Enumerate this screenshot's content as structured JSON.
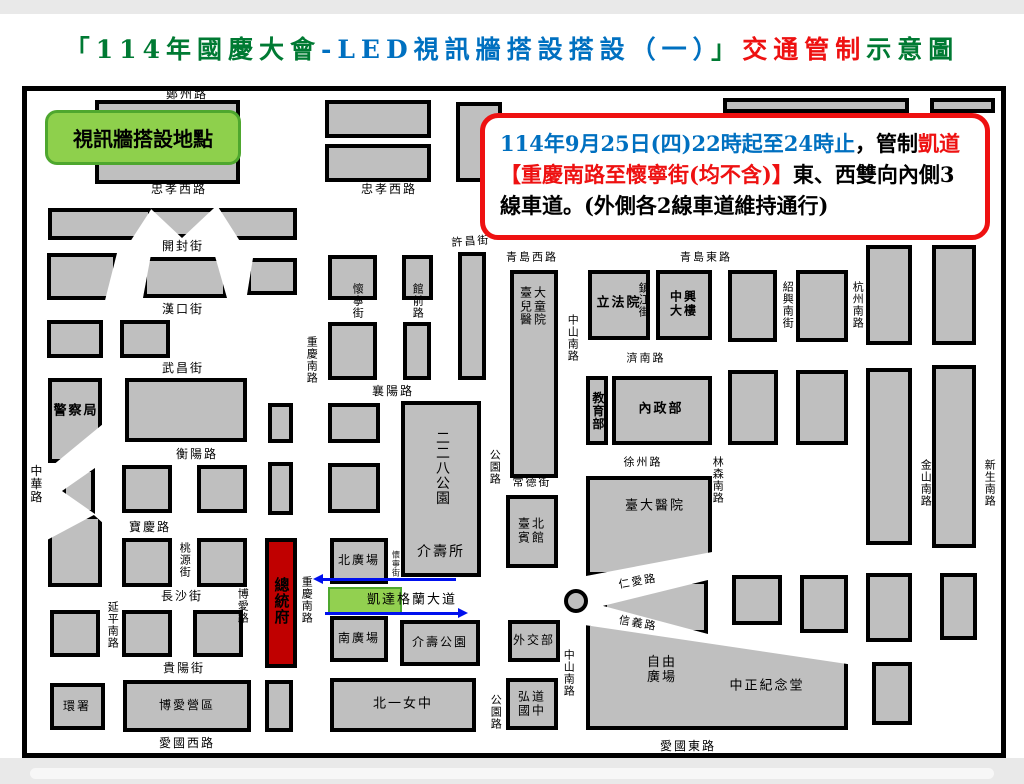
{
  "title": {
    "segments": [
      {
        "t": "「114年國慶大會",
        "c": "#007a33"
      },
      {
        "t": "-LED視訊牆搭設搭設（一）",
        "c": "#0070c0"
      },
      {
        "t": "」",
        "c": "#007a33"
      },
      {
        "t": "交通管制",
        "c": "#ee1111"
      },
      {
        "t": "示意圖",
        "c": "#007a33"
      }
    ]
  },
  "legend_box": {
    "label": "視訊牆搭設地點",
    "fill": "#8ed04c",
    "border": "#4ea72e"
  },
  "notice_box": {
    "border": "#ee1111",
    "lines": [
      [
        {
          "t": "114年9月25日(四)22時起至24時止",
          "c": "#0070c0"
        },
        {
          "t": "，管制",
          "c": "#000000"
        },
        {
          "t": "凱道",
          "c": "#ee1111"
        }
      ],
      [
        {
          "t": "【重慶南路至懷寧街(均不含)】",
          "c": "#ee1111"
        },
        {
          "t": "東、西雙向內側3",
          "c": "#000000"
        }
      ],
      [
        {
          "t": "線車道。(外側各2線車道維持通行)",
          "c": "#000000"
        }
      ]
    ]
  },
  "map": {
    "block_fill": "#bfbfbf",
    "president_fill": "#c00000",
    "kaidao_fill": "#92d050",
    "arrow_color": "#0010ee",
    "roundabout": {
      "cx": 576,
      "cy": 601
    },
    "arrows": [
      {
        "x": 322,
        "y": 578,
        "w": 134,
        "dir": "left"
      },
      {
        "x": 325,
        "y": 612,
        "w": 134,
        "dir": "right"
      }
    ],
    "blocks": [
      {
        "x": 95,
        "y": 100,
        "w": 145,
        "h": 40
      },
      {
        "x": 95,
        "y": 146,
        "w": 145,
        "h": 38
      },
      {
        "x": 325,
        "y": 100,
        "w": 106,
        "h": 38
      },
      {
        "x": 325,
        "y": 144,
        "w": 106,
        "h": 38
      },
      {
        "x": 456,
        "y": 102,
        "w": 46,
        "h": 80
      },
      {
        "x": 723,
        "y": 98,
        "w": 186,
        "h": 15
      },
      {
        "x": 930,
        "y": 98,
        "w": 65,
        "h": 15
      },
      {
        "x": 48,
        "y": 208,
        "w": 104,
        "h": 32,
        "clip": "polygon(0 0,100% 0,80% 100%,0 100%)"
      },
      {
        "x": 150,
        "y": 208,
        "w": 64,
        "h": 30,
        "clip": "polygon(0 0,100% 0,50% 100%)"
      },
      {
        "x": 212,
        "y": 208,
        "w": 85,
        "h": 32,
        "clip": "polygon(8% 0,100% 0,100% 100%,32% 100%)"
      },
      {
        "x": 47,
        "y": 253,
        "w": 70,
        "h": 47,
        "clip": "polygon(0 0,100% 0,83% 100%,0 100%)"
      },
      {
        "x": 143,
        "y": 257,
        "w": 84,
        "h": 41,
        "clip": "polygon(9% 0,86% 0,100% 100%,0 100%)"
      },
      {
        "x": 247,
        "y": 258,
        "w": 50,
        "h": 37,
        "clip": "polygon(12% 0,100% 0,100% 100%,0 100%)"
      },
      {
        "x": 328,
        "y": 255,
        "w": 49,
        "h": 45
      },
      {
        "x": 402,
        "y": 255,
        "w": 31,
        "h": 45
      },
      {
        "x": 458,
        "y": 252,
        "w": 28,
        "h": 128
      },
      {
        "x": 328,
        "y": 322,
        "w": 49,
        "h": 58
      },
      {
        "x": 403,
        "y": 322,
        "w": 28,
        "h": 58
      },
      {
        "x": 47,
        "y": 320,
        "w": 56,
        "h": 38
      },
      {
        "x": 120,
        "y": 320,
        "w": 50,
        "h": 38
      },
      {
        "x": 48,
        "y": 378,
        "w": 54,
        "h": 85,
        "clip": "polygon(0 0,100% 0,100% 55%,14% 100%,0 100%)"
      },
      {
        "x": 125,
        "y": 378,
        "w": 122,
        "h": 64
      },
      {
        "x": 268,
        "y": 403,
        "w": 25,
        "h": 40
      },
      {
        "x": 328,
        "y": 403,
        "w": 52,
        "h": 40
      },
      {
        "x": 401,
        "y": 401,
        "w": 80,
        "h": 176
      },
      {
        "x": 62,
        "y": 468,
        "w": 33,
        "h": 46,
        "clip": "polygon(100% 0,100% 100%,0 50%)"
      },
      {
        "x": 48,
        "y": 515,
        "w": 54,
        "h": 72,
        "clip": "polygon(0 34%,85% 0,100% 10%,100% 100%,0 100%)"
      },
      {
        "x": 122,
        "y": 465,
        "w": 50,
        "h": 48
      },
      {
        "x": 197,
        "y": 465,
        "w": 50,
        "h": 48
      },
      {
        "x": 268,
        "y": 462,
        "w": 25,
        "h": 53
      },
      {
        "x": 328,
        "y": 463,
        "w": 52,
        "h": 50
      },
      {
        "x": 122,
        "y": 538,
        "w": 50,
        "h": 49
      },
      {
        "x": 197,
        "y": 538,
        "w": 50,
        "h": 49
      },
      {
        "x": 265,
        "y": 538,
        "w": 32,
        "h": 130,
        "fill": "#c00000",
        "n": "presidential-office-block"
      },
      {
        "x": 330,
        "y": 538,
        "w": 58,
        "h": 46
      },
      {
        "x": 330,
        "y": 616,
        "w": 58,
        "h": 46
      },
      {
        "x": 400,
        "y": 620,
        "w": 80,
        "h": 46
      },
      {
        "x": 506,
        "y": 495,
        "w": 52,
        "h": 73
      },
      {
        "x": 510,
        "y": 270,
        "w": 48,
        "h": 208
      },
      {
        "x": 50,
        "y": 610,
        "w": 50,
        "h": 47
      },
      {
        "x": 122,
        "y": 610,
        "w": 50,
        "h": 47
      },
      {
        "x": 193,
        "y": 610,
        "w": 50,
        "h": 47
      },
      {
        "x": 50,
        "y": 683,
        "w": 55,
        "h": 47
      },
      {
        "x": 123,
        "y": 680,
        "w": 128,
        "h": 52
      },
      {
        "x": 265,
        "y": 680,
        "w": 28,
        "h": 52
      },
      {
        "x": 330,
        "y": 678,
        "w": 146,
        "h": 54
      },
      {
        "x": 506,
        "y": 678,
        "w": 52,
        "h": 52
      },
      {
        "x": 508,
        "y": 620,
        "w": 52,
        "h": 42
      },
      {
        "x": 588,
        "y": 270,
        "w": 62,
        "h": 70
      },
      {
        "x": 656,
        "y": 270,
        "w": 56,
        "h": 70
      },
      {
        "x": 728,
        "y": 270,
        "w": 49,
        "h": 72
      },
      {
        "x": 796,
        "y": 270,
        "w": 52,
        "h": 72
      },
      {
        "x": 866,
        "y": 245,
        "w": 46,
        "h": 100
      },
      {
        "x": 932,
        "y": 245,
        "w": 44,
        "h": 100
      },
      {
        "x": 586,
        "y": 376,
        "w": 22,
        "h": 69
      },
      {
        "x": 612,
        "y": 376,
        "w": 100,
        "h": 69
      },
      {
        "x": 728,
        "y": 370,
        "w": 50,
        "h": 75
      },
      {
        "x": 796,
        "y": 370,
        "w": 52,
        "h": 75
      },
      {
        "x": 866,
        "y": 368,
        "w": 46,
        "h": 177
      },
      {
        "x": 932,
        "y": 365,
        "w": 44,
        "h": 183
      },
      {
        "x": 586,
        "y": 476,
        "w": 126,
        "h": 100,
        "clip": "polygon(0 0,100% 0,100% 76%,0 100%)"
      },
      {
        "x": 603,
        "y": 580,
        "w": 105,
        "h": 54,
        "clip": "polygon(0 48%,100% 0,100% 100%)"
      },
      {
        "x": 586,
        "y": 622,
        "w": 262,
        "h": 108,
        "clip": "polygon(0 3%,100% 39%,100% 100%,0 100%)"
      },
      {
        "x": 732,
        "y": 575,
        "w": 50,
        "h": 50
      },
      {
        "x": 800,
        "y": 575,
        "w": 48,
        "h": 58
      },
      {
        "x": 866,
        "y": 573,
        "w": 46,
        "h": 69
      },
      {
        "x": 940,
        "y": 573,
        "w": 37,
        "h": 67
      },
      {
        "x": 872,
        "y": 662,
        "w": 40,
        "h": 63
      },
      {
        "x": 328,
        "y": 587,
        "w": 74,
        "h": 28,
        "fill": "#92d050",
        "bc": "#4ea72e",
        "bw": 2,
        "n": "kaidao-led-zone"
      }
    ],
    "labels": [
      {
        "t": "鄭州路",
        "x": 187,
        "y": 95
      },
      {
        "t": "忠孝西路",
        "x": 179,
        "y": 190
      },
      {
        "t": "忠孝西路",
        "x": 389,
        "y": 190
      },
      {
        "t": "開封街",
        "x": 183,
        "y": 247
      },
      {
        "t": "漢口街",
        "x": 183,
        "y": 310
      },
      {
        "t": "武昌街",
        "x": 183,
        "y": 369
      },
      {
        "t": "許昌街",
        "x": 471,
        "y": 242,
        "s": 11,
        "r": -4
      },
      {
        "t": "青島西路",
        "x": 532,
        "y": 258,
        "s": 11
      },
      {
        "t": "青島東路",
        "x": 706,
        "y": 258,
        "s": 11
      },
      {
        "t": "襄陽路",
        "x": 393,
        "y": 392
      },
      {
        "t": "衡陽路",
        "x": 197,
        "y": 455
      },
      {
        "t": "寶慶路",
        "x": 150,
        "y": 528
      },
      {
        "t": "長沙街",
        "x": 182,
        "y": 597
      },
      {
        "t": "貴陽街",
        "x": 184,
        "y": 669
      },
      {
        "t": "愛國西路",
        "x": 187,
        "y": 744
      },
      {
        "t": "愛國東路",
        "x": 688,
        "y": 747
      },
      {
        "t": "濟南路",
        "x": 646,
        "y": 359,
        "s": 11
      },
      {
        "t": "徐州路",
        "x": 643,
        "y": 463,
        "s": 11
      },
      {
        "t": "仁愛路",
        "x": 638,
        "y": 582,
        "s": 11,
        "r": -10
      },
      {
        "t": "信義路",
        "x": 638,
        "y": 624,
        "s": 11,
        "r": 10
      },
      {
        "t": "凱達格蘭大道",
        "x": 412,
        "y": 601,
        "s": 13
      },
      {
        "t": "中華路",
        "x": 35,
        "y": 484,
        "v": 1
      },
      {
        "t": "延平南路",
        "x": 112,
        "y": 625,
        "v": 1,
        "s": 11
      },
      {
        "t": "博愛路",
        "x": 242,
        "y": 606,
        "v": 1,
        "s": 11
      },
      {
        "t": "桃源街",
        "x": 184,
        "y": 560,
        "v": 1,
        "s": 11
      },
      {
        "t": "重慶南路",
        "x": 311,
        "y": 360,
        "v": 1,
        "s": 11
      },
      {
        "t": "重慶南路",
        "x": 306,
        "y": 600,
        "v": 1,
        "s": 11
      },
      {
        "t": "懷寧街",
        "x": 357,
        "y": 301,
        "v": 1,
        "s": 11
      },
      {
        "t": "懷寧街",
        "x": 396,
        "y": 564,
        "v": 1,
        "s": 8
      },
      {
        "t": "館前路",
        "x": 417,
        "y": 301,
        "v": 1,
        "s": 11
      },
      {
        "t": "公園路",
        "x": 494,
        "y": 467,
        "v": 1,
        "s": 11
      },
      {
        "t": "公園路",
        "x": 495,
        "y": 712,
        "v": 1,
        "s": 11
      },
      {
        "t": "常德街",
        "x": 532,
        "y": 483,
        "s": 11
      },
      {
        "t": "中山南路",
        "x": 572,
        "y": 338,
        "v": 1,
        "s": 11
      },
      {
        "t": "中山南路",
        "x": 568,
        "y": 673,
        "v": 1,
        "s": 11
      },
      {
        "t": "鎮江街",
        "x": 643,
        "y": 300,
        "v": 1,
        "s": 11
      },
      {
        "t": "紹興南街",
        "x": 787,
        "y": 305,
        "v": 1,
        "s": 11
      },
      {
        "t": "杭州南路",
        "x": 857,
        "y": 305,
        "v": 1,
        "s": 11
      },
      {
        "t": "林森南路",
        "x": 717,
        "y": 480,
        "v": 1,
        "s": 11
      },
      {
        "t": "金山南路",
        "x": 925,
        "y": 483,
        "v": 1,
        "s": 11
      },
      {
        "t": "新生南路",
        "x": 989,
        "y": 483,
        "v": 1,
        "s": 11
      },
      {
        "t": "警察局",
        "x": 76,
        "y": 412,
        "b": 1,
        "s": 13,
        "n": "place-label"
      },
      {
        "t": "總統府",
        "x": 281,
        "y": 601,
        "v": 1,
        "b": 1,
        "s": 15,
        "n": "place-label"
      },
      {
        "t": "北廣場",
        "x": 359,
        "y": 561,
        "n": "place-label"
      },
      {
        "t": "南廣場",
        "x": 359,
        "y": 639,
        "n": "place-label"
      },
      {
        "t": "介壽公園",
        "x": 440,
        "y": 643,
        "n": "place-label"
      },
      {
        "t": "北一女中",
        "x": 403,
        "y": 705,
        "s": 13,
        "n": "place-label"
      },
      {
        "t": "博愛營區",
        "x": 187,
        "y": 706,
        "n": "place-label"
      },
      {
        "t": "環署",
        "x": 77,
        "y": 707,
        "n": "place-label"
      },
      {
        "t": "弘道\n國中",
        "x": 532,
        "y": 704,
        "n": "place-label"
      },
      {
        "t": "外交部",
        "x": 534,
        "y": 641,
        "n": "place-label"
      },
      {
        "t": "二二八公園",
        "x": 441,
        "y": 468,
        "v": 1,
        "s": 14,
        "n": "place-label"
      },
      {
        "t": "介壽所",
        "x": 441,
        "y": 553,
        "s": 14,
        "n": "place-label"
      },
      {
        "t": "臺大\n兒童\n醫院",
        "x": 534,
        "y": 307,
        "s": 12,
        "n": "place-label"
      },
      {
        "t": "臺北\n賓館",
        "x": 532,
        "y": 531,
        "n": "place-label"
      },
      {
        "t": "立法院",
        "x": 619,
        "y": 304,
        "b": 1,
        "s": 13,
        "n": "place-label"
      },
      {
        "t": "中興\n大樓",
        "x": 684,
        "y": 304,
        "b": 1,
        "s": 12,
        "n": "place-label"
      },
      {
        "t": "教育部",
        "x": 597,
        "y": 411,
        "v": 1,
        "b": 1,
        "s": 12,
        "n": "place-label"
      },
      {
        "t": "內政部",
        "x": 661,
        "y": 410,
        "b": 1,
        "s": 13,
        "n": "place-label"
      },
      {
        "t": "臺大醫院",
        "x": 655,
        "y": 507,
        "s": 13,
        "n": "place-label"
      },
      {
        "t": "自由\n廣場",
        "x": 662,
        "y": 671,
        "s": 13,
        "n": "place-label"
      },
      {
        "t": "中正紀念堂",
        "x": 767,
        "y": 687,
        "s": 13,
        "n": "place-label"
      }
    ]
  }
}
